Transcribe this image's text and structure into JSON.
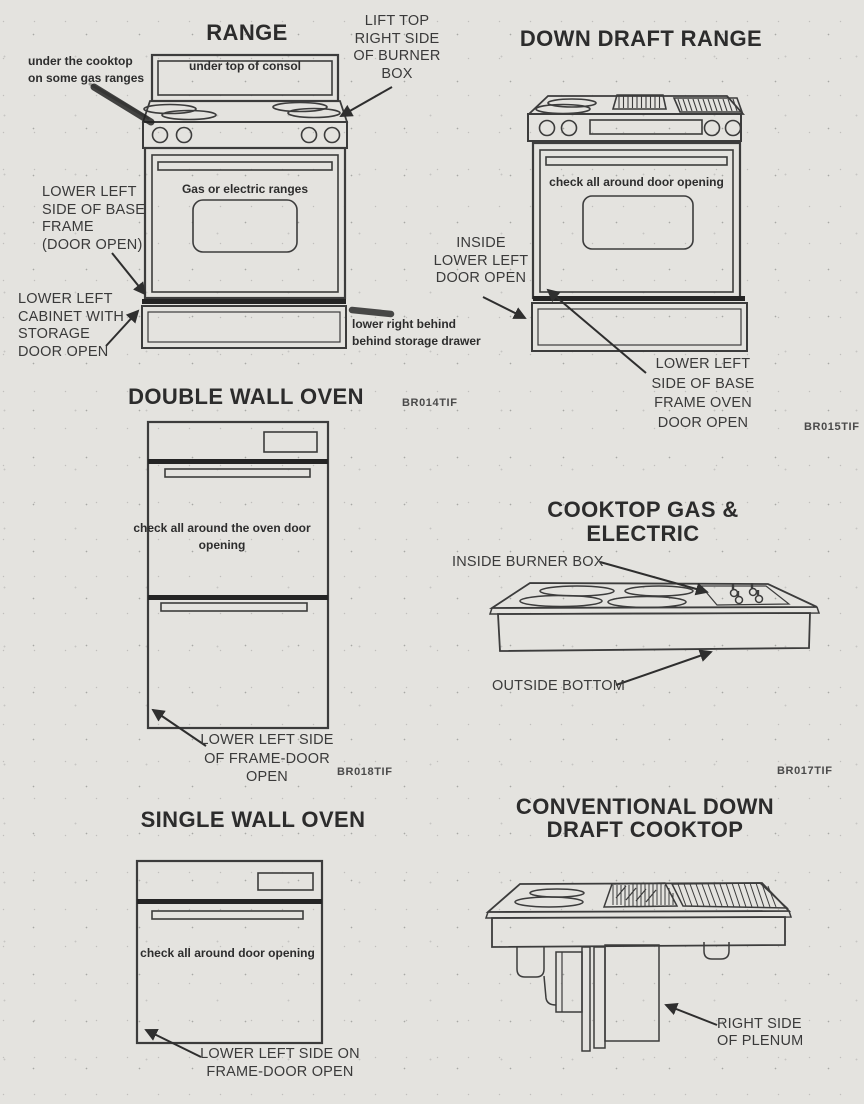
{
  "page": {
    "background": "#e4e3df",
    "ink": "#2e2e2e"
  },
  "sections": {
    "range": {
      "title": "RANGE",
      "labels": {
        "under_cooktop": "under the cooktop\non some gas ranges",
        "lift_top": "LIFT TOP\nRIGHT SIDE\nOF BURNER\nBOX",
        "under_console": "under top of consol",
        "oven_type": "Gas or electric ranges",
        "lower_left_base": "LOWER LEFT\nSIDE OF BASE\nFRAME\n(DOOR OPEN)",
        "lower_left_cabinet": "LOWER LEFT\nCABINET WITH\nSTORAGE\nDOOR OPEN",
        "lower_right_drawer": "lower right behind\nbehind storage drawer"
      }
    },
    "down_draft_range": {
      "title": "DOWN DRAFT RANGE",
      "labels": {
        "check_door": "check all around door opening",
        "inside_lower_left": "INSIDE\nLOWER LEFT\nDOOR OPEN",
        "lower_left_base": "LOWER LEFT\nSIDE OF BASE\nFRAME OVEN\nDOOR OPEN"
      },
      "figure_code": "BR015TIF"
    },
    "double_wall_oven": {
      "title": "DOUBLE WALL OVEN",
      "figure_code_top": "BR014TIF",
      "labels": {
        "check_door": "check all around the oven door opening",
        "lower_left": "LOWER LEFT SIDE\nOF FRAME-DOOR\nOPEN"
      },
      "figure_code_bottom": "BR018TIF"
    },
    "cooktop_gas_electric": {
      "title": "COOKTOP GAS & ELECTRIC",
      "labels": {
        "inside_burner_box": "INSIDE BURNER BOX",
        "outside_bottom": "OUTSIDE BOTTOM"
      },
      "figure_code": "BR017TIF"
    },
    "single_wall_oven": {
      "title": "SINGLE WALL OVEN",
      "labels": {
        "check_door": "check all around door opening",
        "lower_left": "LOWER LEFT SIDE ON\nFRAME-DOOR OPEN"
      }
    },
    "conventional_down_draft_cooktop": {
      "title": "CONVENTIONAL DOWN\nDRAFT COOKTOP",
      "labels": {
        "right_side_plenum": "RIGHT SIDE\nOF PLENUM"
      }
    }
  }
}
